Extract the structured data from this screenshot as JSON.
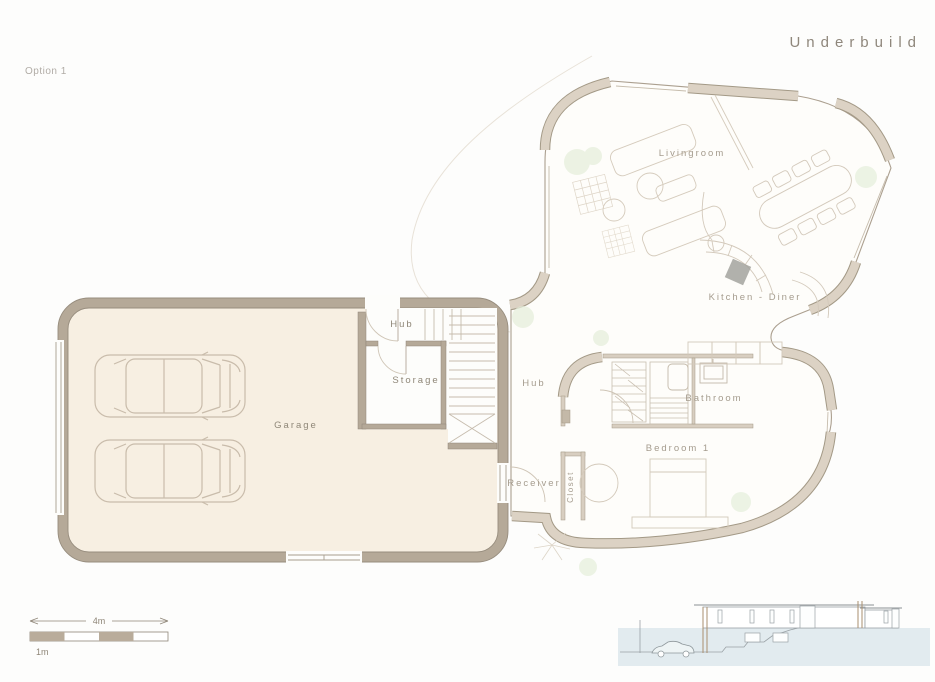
{
  "page": {
    "option_label": "Option 1",
    "title": "Underbuild"
  },
  "plan": {
    "rooms": {
      "garage": "Garage",
      "hub_lower": "Hub",
      "storage": "Storage",
      "hub_upper": "Hub",
      "livingroom": "Livingroom",
      "kitchen_diner": "Kitchen - Diner",
      "bathroom": "Bathroom",
      "bedroom": "Bedroom 1",
      "receiver": "Receiver",
      "closet": "Closet"
    },
    "features": [
      "2 cars in garage",
      "L-shaped staircase",
      "wardrobe",
      "bed",
      "dining table with chairs",
      "kitchen counter with hob",
      "sofas and rug in livingroom"
    ]
  },
  "scale_bar": {
    "total": "4m",
    "unit": "1m"
  },
  "elevation": {
    "description": "side section showing underbuild garage cut into slope with car"
  },
  "colors": {
    "garage_wall": "#b5a998",
    "garage_floor": "#f7efe2",
    "upper_wall": "#dcd2c4",
    "wall_edge": "#8f8578",
    "thin_line": "#b3a899",
    "furniture_line": "#d5cbbc",
    "label": "#a59c8e",
    "title": "#8f877c",
    "plant_green": "#e6efdc",
    "ground_blue": "#e2ebef",
    "hob_gray": "#a3a39e"
  }
}
